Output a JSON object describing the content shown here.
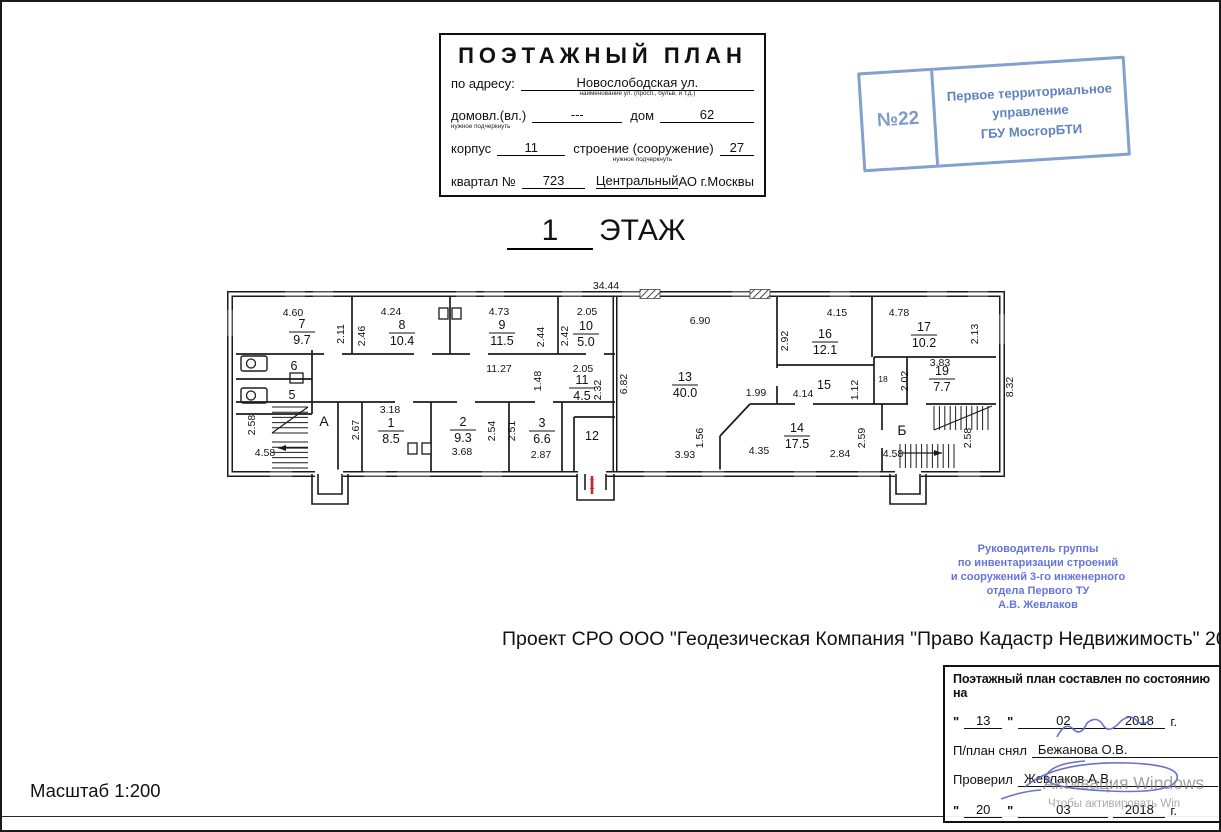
{
  "title_block": {
    "title": "ПОЭТАЖНЫЙ ПЛАН",
    "address_label": "по адресу:",
    "address_value": "Новослободская ул.",
    "address_caption": "наименование ул. (просп., бульв. и т.д.)",
    "ownership_label": "домовл.(вл.)",
    "ownership_caption": "нужное подчеркнуть",
    "ownership_value": "---",
    "house_label": "дом",
    "house_value": "62",
    "building_label": "корпус",
    "building_value": "11",
    "structure_label": "строение (сооружение)",
    "structure_caption": "нужное подчеркнуть",
    "structure_value": "27",
    "block_label": "квартал №",
    "block_value": "723",
    "district_value": "Центральный",
    "district_suffix": "АО г.Москвы"
  },
  "registration_stamp": {
    "number": "№22",
    "line1": "Первое территориальное",
    "line2": "управление",
    "line3": "ГБУ МосгорБТИ",
    "color": "#5078ba"
  },
  "floor_title": {
    "number": "1",
    "word": "ЭТАЖ"
  },
  "plan": {
    "overall_width_m": "34.44",
    "overall_depth_m": "8.32",
    "rooms": [
      {
        "num": "7",
        "area": "9.7",
        "x": 300,
        "y": 330
      },
      {
        "num": "8",
        "area": "10.4",
        "x": 400,
        "y": 331
      },
      {
        "num": "9",
        "area": "11.5",
        "x": 500,
        "y": 331
      },
      {
        "num": "10",
        "area": "5.0",
        "x": 584,
        "y": 332
      },
      {
        "num": "11",
        "area": "4.5",
        "x": 580,
        "y": 386
      },
      {
        "num": "13",
        "area": "40.0",
        "x": 683,
        "y": 383
      },
      {
        "num": "16",
        "area": "12.1",
        "x": 823,
        "y": 340
      },
      {
        "num": "17",
        "area": "10.2",
        "x": 922,
        "y": 333
      },
      {
        "num": "19",
        "area": "7.7",
        "x": 940,
        "y": 377
      },
      {
        "num": "1",
        "area": "8.5",
        "x": 389,
        "y": 429
      },
      {
        "num": "2",
        "area": "9.3",
        "x": 461,
        "y": 428
      },
      {
        "num": "3",
        "area": "6.6",
        "x": 540,
        "y": 429
      },
      {
        "num": "14",
        "area": "17.5",
        "x": 795,
        "y": 434
      }
    ],
    "marks": [
      {
        "t": "6",
        "x": 292,
        "y": 368
      },
      {
        "t": "5",
        "x": 290,
        "y": 397
      },
      {
        "t": "12",
        "x": 590,
        "y": 438
      },
      {
        "t": "15",
        "x": 822,
        "y": 387
      },
      {
        "t": "18",
        "x": 881,
        "y": 380,
        "s": "small"
      },
      {
        "t": "А",
        "x": 322,
        "y": 424,
        "s": "big"
      },
      {
        "t": "Б",
        "x": 900,
        "y": 433,
        "s": "big"
      }
    ],
    "dimensions": [
      {
        "t": "34.44",
        "x": 604,
        "y": 287
      },
      {
        "t": "8.32",
        "x": 1011,
        "y": 385,
        "r": 1
      },
      {
        "t": "4.60",
        "x": 291,
        "y": 314
      },
      {
        "t": "2.11",
        "x": 342,
        "y": 332,
        "r": 1
      },
      {
        "t": "4.24",
        "x": 389,
        "y": 313
      },
      {
        "t": "2.46",
        "x": 363,
        "y": 334,
        "r": 1
      },
      {
        "t": "4.73",
        "x": 497,
        "y": 313
      },
      {
        "t": "2.44",
        "x": 542,
        "y": 335,
        "r": 1
      },
      {
        "t": "2.05",
        "x": 585,
        "y": 313
      },
      {
        "t": "2.42",
        "x": 566,
        "y": 334,
        "r": 1
      },
      {
        "t": "6.90",
        "x": 698,
        "y": 322
      },
      {
        "t": "6.82",
        "x": 625,
        "y": 382,
        "r": 1
      },
      {
        "t": "4.15",
        "x": 835,
        "y": 314
      },
      {
        "t": "2.92",
        "x": 786,
        "y": 339,
        "r": 1
      },
      {
        "t": "4.78",
        "x": 897,
        "y": 314
      },
      {
        "t": "2.13",
        "x": 976,
        "y": 332,
        "r": 1
      },
      {
        "t": "11.27",
        "x": 497,
        "y": 370
      },
      {
        "t": "1.48",
        "x": 539,
        "y": 379,
        "r": 1
      },
      {
        "t": "2.05",
        "x": 581,
        "y": 370
      },
      {
        "t": "2.32",
        "x": 599,
        "y": 388,
        "r": 1
      },
      {
        "t": "1.99",
        "x": 754,
        "y": 394
      },
      {
        "t": "4.14",
        "x": 801,
        "y": 395
      },
      {
        "t": "1.12",
        "x": 856,
        "y": 388,
        "r": 1
      },
      {
        "t": "2.02",
        "x": 906,
        "y": 379,
        "r": 1
      },
      {
        "t": "3.83",
        "x": 938,
        "y": 364
      },
      {
        "t": "2.58",
        "x": 253,
        "y": 423,
        "r": 1
      },
      {
        "t": "4.58",
        "x": 263,
        "y": 454
      },
      {
        "t": "2.67",
        "x": 357,
        "y": 428,
        "r": 1
      },
      {
        "t": "3.18",
        "x": 388,
        "y": 411
      },
      {
        "t": "2.54",
        "x": 493,
        "y": 429,
        "r": 1
      },
      {
        "t": "3.68",
        "x": 460,
        "y": 453
      },
      {
        "t": "2.51",
        "x": 513,
        "y": 429,
        "r": 1
      },
      {
        "t": "2.87",
        "x": 539,
        "y": 456
      },
      {
        "t": "3.93",
        "x": 683,
        "y": 456
      },
      {
        "t": "1.56",
        "x": 701,
        "y": 436,
        "r": 1
      },
      {
        "t": "4.35",
        "x": 757,
        "y": 452
      },
      {
        "t": "2.84",
        "x": 838,
        "y": 455
      },
      {
        "t": "2.59",
        "x": 863,
        "y": 436,
        "r": 1
      },
      {
        "t": "4.58",
        "x": 891,
        "y": 455
      },
      {
        "t": "2.58",
        "x": 969,
        "y": 436,
        "r": 1
      }
    ],
    "entrance_mark": {
      "t": "I",
      "x": 590,
      "y": 487,
      "color": "#c2272b"
    }
  },
  "approval_stamp": {
    "lines": [
      "Руководитель группы",
      "по инвентаризации строений",
      "и сооружений 3-го инженерного",
      "отдела Первого ТУ",
      "А.В. Жевлаков"
    ],
    "color": "#4a5cd6"
  },
  "project_line": "Проект СРО ООО \"Геодезическая Компания \"Право Кадастр Недвижимость\" 2017г.",
  "signature_block": {
    "header": "Поэтажный план составлен по состоянию на",
    "quote": "\"",
    "date1": {
      "day": "13",
      "month": "02",
      "year": "2018",
      "suffix": "г."
    },
    "made_label": "П/план снял",
    "made_name": "Бежанова О.В.",
    "checked_label": "Проверил",
    "checked_name": "Жевлаков А.В.",
    "date2": {
      "day": "20",
      "month": "03",
      "year": "2018",
      "suffix": "г."
    }
  },
  "scale_label": "Масштаб 1:200",
  "watermark": {
    "line1": "Активация Windows",
    "line2": "Чтобы активировать Win"
  }
}
